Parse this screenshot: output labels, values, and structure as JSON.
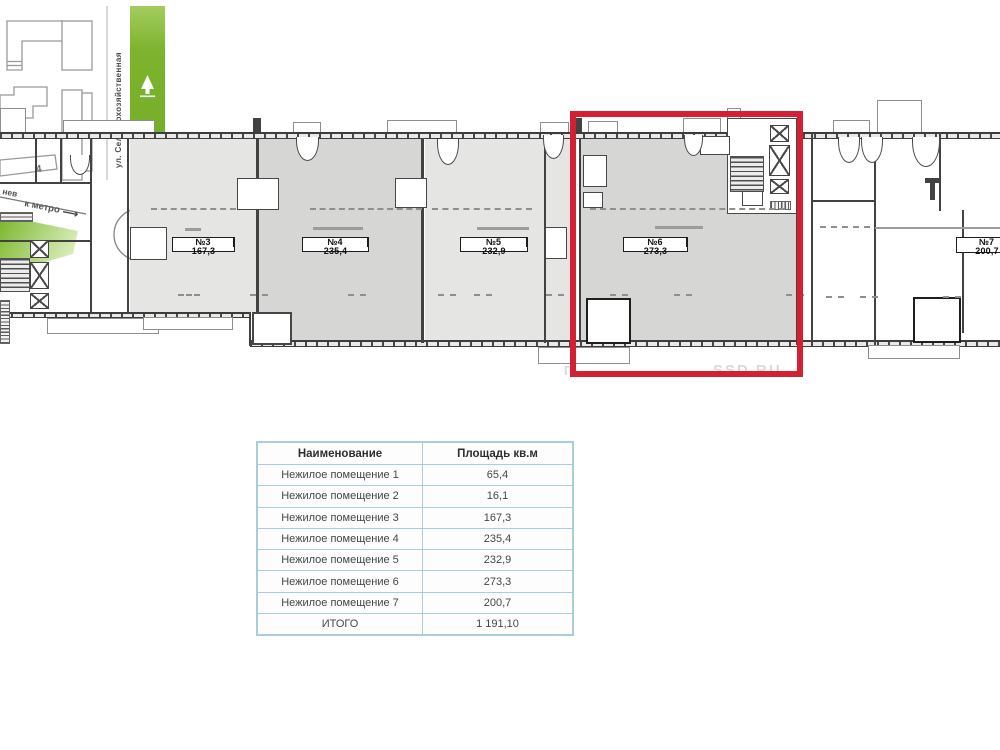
{
  "plan": {
    "watermark": "SSD.RU",
    "watermark_partial": "П",
    "highlight_color": "#d32133",
    "labels": [
      {
        "no": "№3",
        "area": "167,3"
      },
      {
        "no": "№4",
        "area": "235,4"
      },
      {
        "no": "№5",
        "area": "232,9"
      },
      {
        "no": "№6",
        "area": "273,3"
      },
      {
        "no": "№7",
        "area": "200,7"
      }
    ]
  },
  "table": {
    "header": {
      "name": "Наименование",
      "area": "Площадь кв.м"
    },
    "rows": [
      {
        "name": "Нежилое помещение 1",
        "area": "65,4"
      },
      {
        "name": "Нежилое помещение 2",
        "area": "16,1"
      },
      {
        "name": "Нежилое помещение 3",
        "area": "167,3"
      },
      {
        "name": "Нежилое помещение 4",
        "area": "235,4"
      },
      {
        "name": "Нежилое помещение 5",
        "area": "232,9"
      },
      {
        "name": "Нежилое помещение 6",
        "area": "273,3"
      },
      {
        "name": "Нежилое помещение 7",
        "area": "200,7"
      },
      {
        "name": "ИТОГО",
        "area": "1 191,10"
      }
    ]
  },
  "map": {
    "street_name": "ул. Сельскохозяйственная",
    "street_fragment": "нев",
    "metro_label": "к метро",
    "metro_arrow": "⟶",
    "building_5": "5",
    "building_4": "4",
    "compass_north": "N",
    "street_color": "#7cb82e"
  }
}
